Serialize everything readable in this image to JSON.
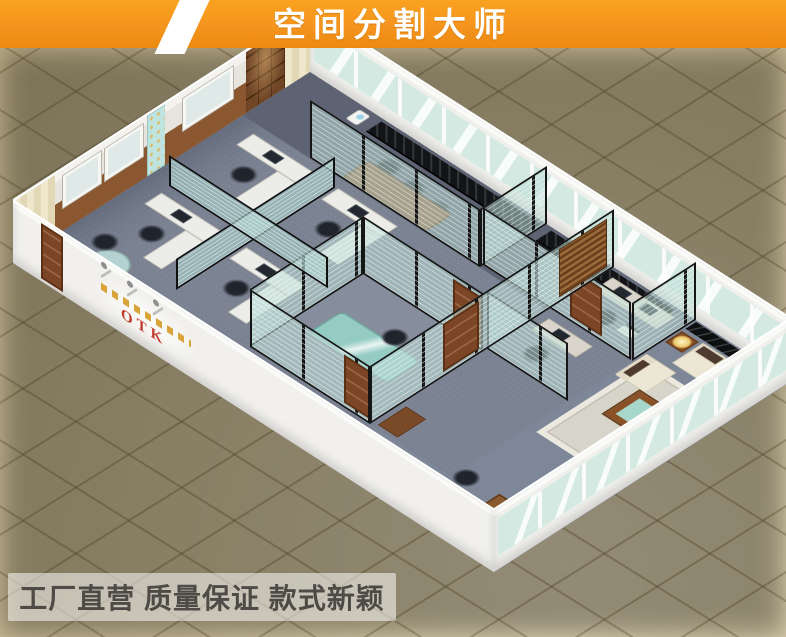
{
  "banner": {
    "title": "空间分割大师",
    "bg_color": "#f5941e",
    "stripe_color": "#ffffff",
    "text_color": "#ffffff"
  },
  "caption": {
    "text": "工厂直营 质量保证 款式新颖",
    "text_color": "#4e4b46",
    "bar_color": "rgba(252,252,250,0.55)"
  },
  "building": {
    "logo": "OTK",
    "logo_color": "#c23b2a",
    "description": "isometric cutaway render of an office divided by glass partitions",
    "rooms": [
      "reception with counter and chairs",
      "open office with four workstations",
      "glass meeting room with conference table",
      "small office with computers and printer",
      "lounge with cream sofa set and coffee table",
      "executive office with wooden desk"
    ]
  },
  "palette": {
    "banner_orange": "#f5941e",
    "background_dark": "#4b4636",
    "tile_beige": "#dbcfa9",
    "carpet_gray": "#7b8393",
    "glass_teal": "#bbddd6",
    "partition_frame_black": "#161616",
    "wall_white": "#f1f0ec",
    "wood_brown": "#8a5731",
    "sofa_cream": "#ece6d4",
    "cushion_brown": "#4e3a2e"
  }
}
